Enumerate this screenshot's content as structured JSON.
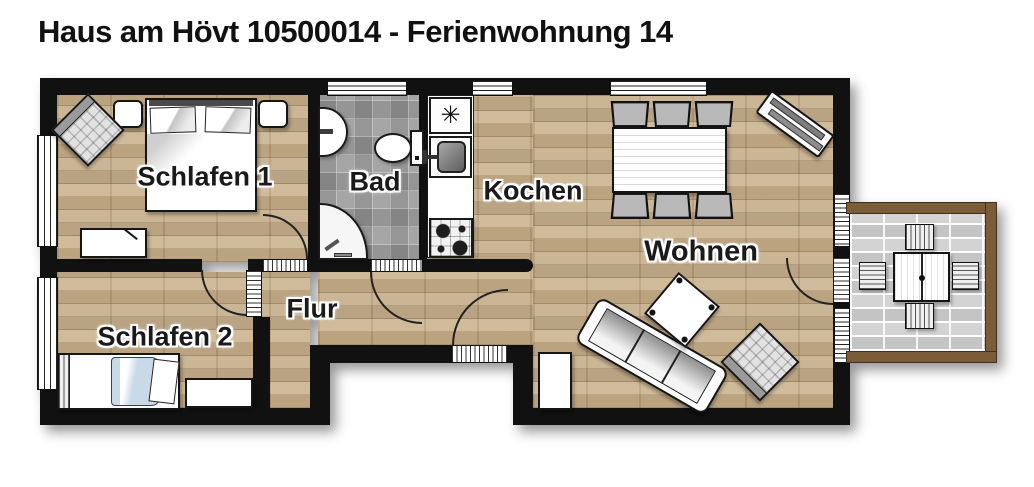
{
  "title": "Haus am Hövt 10500014 - Ferienwohnung 14",
  "rooms": {
    "schlafen1": {
      "label": "Schlafen 1"
    },
    "bad": {
      "label": "Bad"
    },
    "kochen": {
      "label": "Kochen"
    },
    "wohnen": {
      "label": "Wohnen"
    },
    "flur": {
      "label": "Flur"
    },
    "schlafen2": {
      "label": "Schlafen 2"
    }
  },
  "symbols": {
    "freezer_asterisk": "✳"
  },
  "colors": {
    "wall": "#111111",
    "wood_floor": "#c9b493",
    "bathroom_tile": "#9a9a9a",
    "terrace_paving": "#cfcfcf",
    "terrace_frame": "#7b5c39",
    "blanket_blue": "#c8d9e8",
    "background": "#ffffff",
    "title_text": "#111111"
  }
}
